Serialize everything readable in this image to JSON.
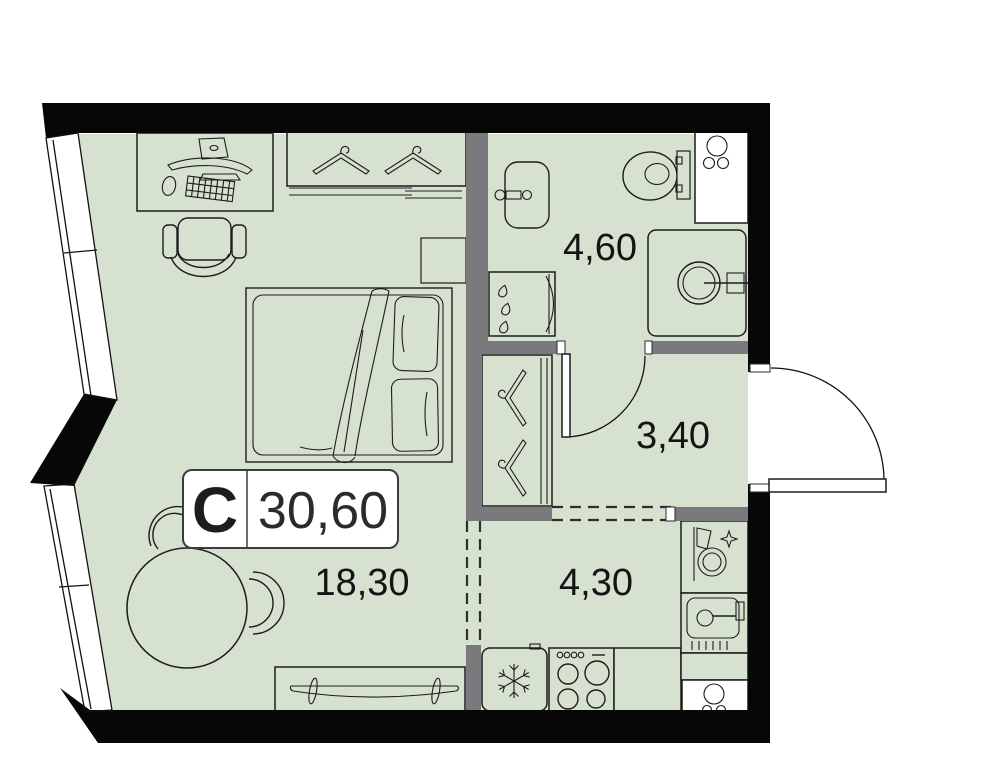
{
  "plan": {
    "unit_badge": {
      "type_letter": "С",
      "total_area": "30,60"
    },
    "rooms": [
      {
        "name": "bathroom",
        "area": "4,60"
      },
      {
        "name": "hallway",
        "area": "3,40"
      },
      {
        "name": "kitchen",
        "area": "4,30"
      },
      {
        "name": "living-room",
        "area": "18,30"
      }
    ],
    "colors": {
      "floor": "#d6e2cf",
      "wall": "#070707",
      "partition": "#7a7a7e",
      "window": "#ffffff",
      "label": "#141414"
    },
    "icons": [
      "desk-icon",
      "monitor-icon",
      "keyboard-icon",
      "mouse-icon",
      "office-chair-icon",
      "wardrobe-icon",
      "hanger-icon",
      "bed-icon",
      "pillow-icon",
      "nightstand-icon",
      "dining-table-icon",
      "chair-icon",
      "tv-stand-icon",
      "tv-icon",
      "wash-basin-icon",
      "shower-icon",
      "toilet-icon",
      "washing-machine-icon",
      "ventilation-shaft-icon",
      "fridge-icon",
      "snowflake-icon",
      "stove-icon",
      "kitchen-sink-icon",
      "clean-dishes-icon",
      "door-swing-icon"
    ]
  }
}
